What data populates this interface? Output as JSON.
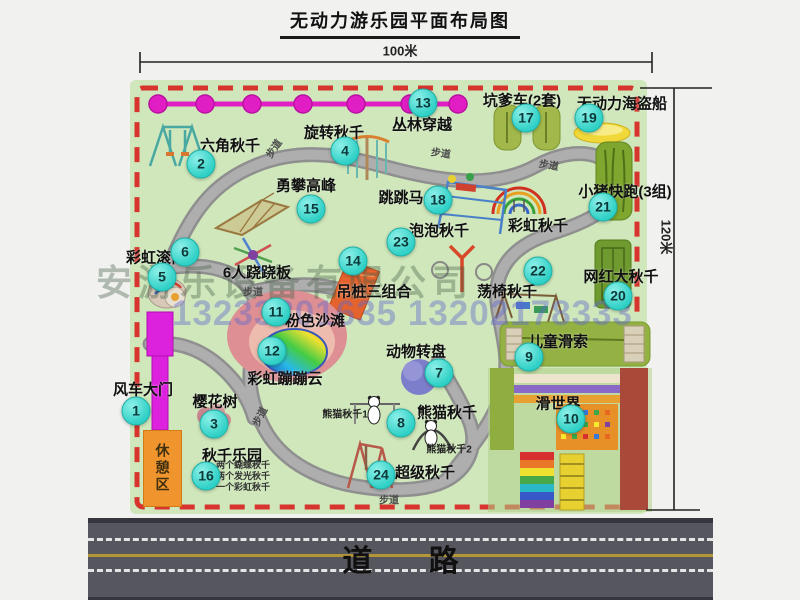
{
  "title": "无动力游乐园平面布局图",
  "dimensions": {
    "width_label": "100米",
    "height_label": "120米"
  },
  "road": {
    "label": "道 路"
  },
  "rest_area_label": "休憩区",
  "path_label": "步道",
  "watermark": {
    "company": "安游乐设备有限公司",
    "phone": "13233801635 13202178333"
  },
  "colors": {
    "park_green": "#cfe7bb",
    "boundary_red": "#d6342c",
    "badge_teal": "#2fd0c6",
    "zipline_magenta": "#e11ec4",
    "gate_magenta": "#dd22dd",
    "rest_orange": "#f0952d",
    "road_gray": "#56565e",
    "road_yellow": "#b49538"
  },
  "attractions": [
    {
      "num": "1",
      "label": "风车大门"
    },
    {
      "num": "2",
      "label": "六角秋千"
    },
    {
      "num": "3",
      "label": "樱花树"
    },
    {
      "num": "4",
      "label": "旋转秋千"
    },
    {
      "num": "5",
      "label": "彩虹滚筒"
    },
    {
      "num": "6",
      "label": "6人跷跷板"
    },
    {
      "num": "7",
      "label": "动物转盘"
    },
    {
      "num": "8",
      "label": "熊猫秋千",
      "notes": [
        "熊猫秋千1",
        "熊猫秋千2"
      ]
    },
    {
      "num": "9",
      "label": "儿童滑索"
    },
    {
      "num": "10",
      "label": "滑世界"
    },
    {
      "num": "11",
      "label": "粉色沙滩"
    },
    {
      "num": "12",
      "label": "彩虹蹦蹦云"
    },
    {
      "num": "13",
      "label": "丛林穿越"
    },
    {
      "num": "14",
      "label": "吊桩三组合"
    },
    {
      "num": "15",
      "label": "勇攀高峰"
    },
    {
      "num": "16",
      "label": "秋千乐园",
      "notes": [
        "两个蝴蝶秋千",
        "两个发光秋千",
        "一个彩虹秋千"
      ]
    },
    {
      "num": "17",
      "label": "坑爹车(2套)"
    },
    {
      "num": "18",
      "label": "跳跳马"
    },
    {
      "num": "19",
      "label": "无动力海盗船"
    },
    {
      "num": "20",
      "label": "网红大秋千"
    },
    {
      "num": "21",
      "label": "小猪快跑(3组)"
    },
    {
      "num": "22",
      "label": "荡椅秋千"
    },
    {
      "num": "23",
      "label": "泡泡秋千"
    },
    {
      "num": "24",
      "label": "超级秋千"
    }
  ]
}
